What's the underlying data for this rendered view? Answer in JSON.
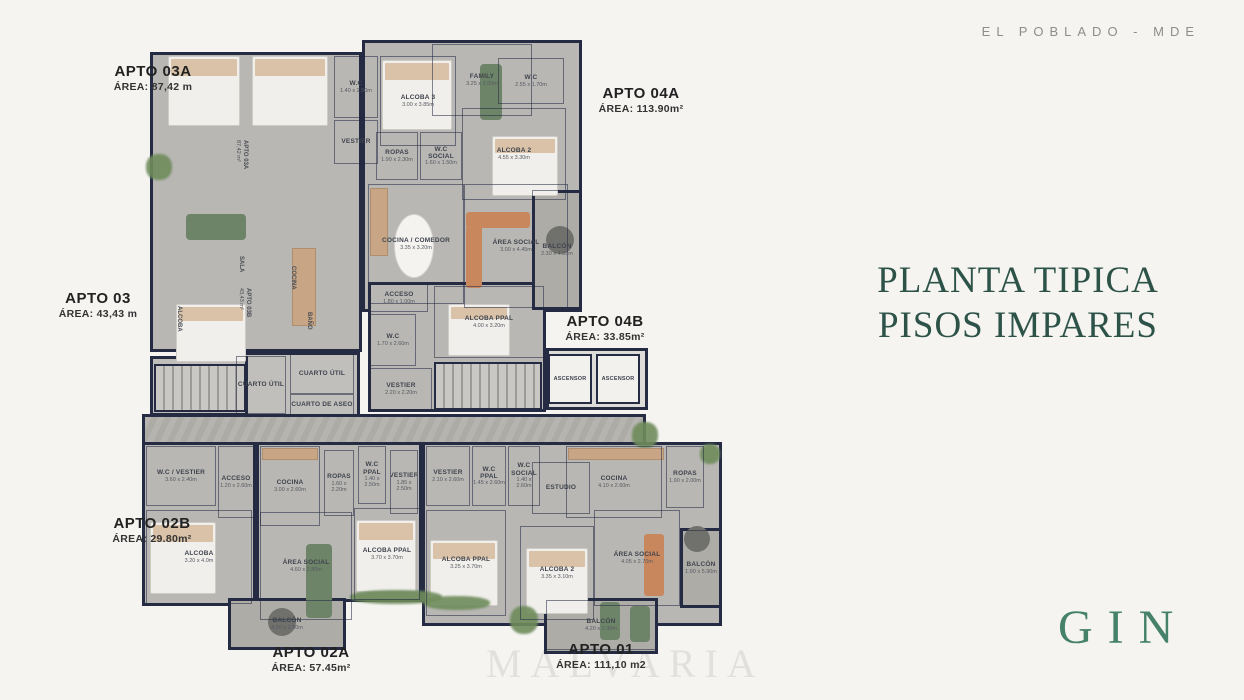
{
  "header": {
    "location_tag": "EL POBLADO - MDE"
  },
  "title": {
    "line1": "PLANTA TIPICA",
    "line2": "PISOS IMPARES"
  },
  "brand": {
    "name": "GIN"
  },
  "watermark": "MALVARIA",
  "colors": {
    "page_bg": "#f5f4f1",
    "title_green": "#2d5349",
    "brand_green": "#45816b",
    "wall_navy": "#242b43",
    "floor_gray": "#b8b7b3",
    "wood_tan": "#c8a685",
    "sofa_green": "#6d8468",
    "sofa_orange": "#c9875e"
  },
  "apartments": [
    {
      "name": "APTO 03A",
      "area": "ÁREA: 87,42 m",
      "cx": 153,
      "y": 64
    },
    {
      "name": "APTO 04A",
      "area": "ÁREA: 113.90m²",
      "cx": 641,
      "y": 86
    },
    {
      "name": "APTO 03",
      "area": "ÁREA: 43,43 m",
      "cx": 98,
      "y": 291
    },
    {
      "name": "APTO 04B",
      "area": "ÁREA: 33.85m²",
      "cx": 605,
      "y": 314
    },
    {
      "name": "APTO 02B",
      "area": "ÁREA: 29.80m²",
      "cx": 152,
      "y": 516
    },
    {
      "name": "APTO 02A",
      "area": "ÁREA: 57.45m²",
      "cx": 311,
      "y": 645
    },
    {
      "name": "APTO 01",
      "area": "ÁREA: 111,10 m2",
      "cx": 601,
      "y": 642
    }
  ],
  "floor_plan": {
    "blocks": [
      {
        "kind": "floor",
        "g": [
          150,
          52,
          212,
          300
        ]
      },
      {
        "kind": "floor",
        "g": [
          362,
          40,
          220,
          272
        ]
      },
      {
        "kind": "floor",
        "g": [
          368,
          282,
          178,
          130
        ]
      },
      {
        "kind": "lobby",
        "g": [
          546,
          348,
          102,
          62
        ]
      },
      {
        "kind": "floor2",
        "g": [
          232,
          352,
          128,
          66
        ]
      },
      {
        "kind": "floor2",
        "g": [
          150,
          356,
          98,
          60
        ]
      },
      {
        "kind": "corridor",
        "g": [
          142,
          414,
          504,
          42
        ]
      },
      {
        "kind": "floor",
        "g": [
          142,
          442,
          114,
          164
        ]
      },
      {
        "kind": "floor",
        "g": [
          256,
          442,
          166,
          160
        ]
      },
      {
        "kind": "floor",
        "g": [
          422,
          442,
          300,
          184
        ]
      },
      {
        "kind": "balcony",
        "g": [
          532,
          190,
          50,
          120
        ]
      },
      {
        "kind": "balcony",
        "g": [
          680,
          528,
          42,
          80
        ]
      },
      {
        "kind": "balcony",
        "g": [
          228,
          598,
          118,
          52
        ]
      },
      {
        "kind": "balcony",
        "g": [
          544,
          598,
          114,
          56
        ]
      }
    ],
    "rooms": [
      {
        "label": "W.C",
        "dims": "1.40 x 2.50m",
        "g": [
          334,
          56,
          44,
          62
        ]
      },
      {
        "label": "VESTIER",
        "dims": "",
        "g": [
          334,
          120,
          44,
          44
        ]
      },
      {
        "label": "ALCOBA 3",
        "dims": "3.00 x 3.85m",
        "g": [
          380,
          56,
          76,
          90
        ]
      },
      {
        "label": "FAMILY",
        "dims": "3.25 x 3.00m",
        "g": [
          432,
          44,
          100,
          72
        ]
      },
      {
        "label": "W.C",
        "dims": "2.55 x 1.70m",
        "g": [
          498,
          58,
          66,
          46
        ]
      },
      {
        "label": "ALCOBA 2",
        "dims": "4.55 x 3.30m",
        "g": [
          462,
          108,
          104,
          92
        ]
      },
      {
        "label": "ROPAS",
        "dims": "1.90 x 2.30m",
        "g": [
          376,
          132,
          42,
          48
        ]
      },
      {
        "label": "W.C SOCIAL",
        "dims": "1.60 x 1.50m",
        "g": [
          420,
          132,
          42,
          48
        ]
      },
      {
        "label": "COCINA / COMEDOR",
        "dims": "3.35 x 3.20m",
        "g": [
          368,
          184,
          96,
          120
        ]
      },
      {
        "label": "ÁREA SOCIAL",
        "dims": "3.00 x 4.45m",
        "g": [
          464,
          184,
          104,
          124
        ]
      },
      {
        "label": "BALCÓN",
        "dims": "2.30 x 4.85m",
        "g": [
          532,
          190,
          50,
          120
        ]
      },
      {
        "label": "ACCESO",
        "dims": "1.80 x 1.00m",
        "g": [
          370,
          284,
          58,
          28
        ]
      },
      {
        "label": "W.C",
        "dims": "1.70 x 2.60m",
        "g": [
          370,
          314,
          46,
          52
        ]
      },
      {
        "label": "VESTIER",
        "dims": "2.20 x 2.20m",
        "g": [
          370,
          368,
          62,
          42
        ]
      },
      {
        "label": "ALCOBA PPAL",
        "dims": "4.00 x 3.20m",
        "g": [
          434,
          286,
          110,
          72
        ]
      },
      {
        "label": "ASCENSOR",
        "dims": "",
        "kind": "lift",
        "g": [
          548,
          354,
          44,
          50
        ]
      },
      {
        "label": "ASCENSOR",
        "dims": "",
        "kind": "lift",
        "g": [
          596,
          354,
          44,
          50
        ]
      },
      {
        "label": "CUARTO ÚTIL",
        "dims": "",
        "g": [
          236,
          356,
          50,
          58
        ]
      },
      {
        "label": "CUARTO ÚTIL",
        "dims": "",
        "g": [
          290,
          354,
          64,
          40
        ]
      },
      {
        "label": "CUARTO DE ASEO",
        "dims": "",
        "g": [
          290,
          394,
          64,
          22
        ]
      },
      {
        "label": "W.C / VESTIER",
        "dims": "3.60 x 2.40m",
        "g": [
          146,
          446,
          70,
          60
        ]
      },
      {
        "label": "ACCESO",
        "dims": "1.20 x 2.60m",
        "g": [
          218,
          446,
          36,
          72
        ]
      },
      {
        "label": "ALCOBA",
        "dims": "3.20 x 4.0m",
        "g": [
          146,
          510,
          106,
          94
        ]
      },
      {
        "label": "COCINA",
        "dims": "3.00 x 2.60m",
        "g": [
          260,
          446,
          60,
          80
        ]
      },
      {
        "label": "ROPAS",
        "dims": "1.60 x 2.20m",
        "g": [
          324,
          450,
          30,
          66
        ]
      },
      {
        "label": "W.C PPAL",
        "dims": "1.40 x 2.50m",
        "g": [
          358,
          446,
          28,
          58
        ]
      },
      {
        "label": "VESTIER",
        "dims": "1.85 x 2.50m",
        "g": [
          390,
          450,
          28,
          64
        ]
      },
      {
        "label": "ÁREA SOCIAL",
        "dims": "4.60 x 2.80m",
        "g": [
          260,
          512,
          92,
          108
        ]
      },
      {
        "label": "ALCOBA PPAL",
        "dims": "3.70 x 3.70m",
        "g": [
          354,
          508,
          66,
          92
        ]
      },
      {
        "label": "BALCÓN",
        "dims": "4.50 x 2.00m",
        "g": [
          230,
          600,
          114,
          48
        ]
      },
      {
        "label": "VESTIER",
        "dims": "2.10 x 2.60m",
        "g": [
          426,
          446,
          44,
          60
        ]
      },
      {
        "label": "W.C PPAL",
        "dims": "1.45 x 2.60m",
        "g": [
          472,
          446,
          34,
          60
        ]
      },
      {
        "label": "W.C SOCIAL",
        "dims": "1.40 x 2.60m",
        "g": [
          508,
          446,
          32,
          60
        ]
      },
      {
        "label": "ESTUDIO",
        "dims": "",
        "g": [
          532,
          462,
          58,
          52
        ]
      },
      {
        "label": "COCINA",
        "dims": "4.10 x 2.60m",
        "g": [
          566,
          446,
          96,
          72
        ]
      },
      {
        "label": "ROPAS",
        "dims": "1.90 x 2.00m",
        "g": [
          666,
          446,
          38,
          62
        ]
      },
      {
        "label": "ALCOBA PPAL",
        "dims": "3.25 x 3.70m",
        "g": [
          426,
          510,
          80,
          106
        ]
      },
      {
        "label": "ALCOBA 2",
        "dims": "3.35 x 3.10m",
        "g": [
          520,
          526,
          74,
          94
        ]
      },
      {
        "label": "ÁREA SOCIAL",
        "dims": "4.05 x 2.70m",
        "g": [
          594,
          510,
          86,
          96
        ]
      },
      {
        "label": "BALCÓN",
        "dims": "1.90 x 5.90m",
        "g": [
          682,
          530,
          38,
          76
        ]
      },
      {
        "label": "BALCÓN",
        "dims": "4.20 x 2.30m",
        "g": [
          546,
          600,
          110,
          50
        ]
      }
    ],
    "rotated_labels": [
      {
        "t": "APTO 03A",
        "s": "87,42 m²",
        "x": 248,
        "y": 140
      },
      {
        "t": "SALA",
        "s": "",
        "x": 244,
        "y": 256
      },
      {
        "t": "COCINA",
        "s": "",
        "x": 296,
        "y": 266
      },
      {
        "t": "APTO 03B",
        "s": "43,43 m²",
        "x": 251,
        "y": 288
      },
      {
        "t": "ALCOBA",
        "s": "",
        "x": 182,
        "y": 306
      },
      {
        "t": "BAÑO",
        "s": "",
        "x": 312,
        "y": 312
      }
    ],
    "furniture": [
      {
        "type": "bed",
        "g": [
          168,
          56,
          72,
          70
        ]
      },
      {
        "type": "bed",
        "g": [
          252,
          56,
          76,
          70
        ]
      },
      {
        "type": "bed",
        "g": [
          382,
          60,
          70,
          70
        ]
      },
      {
        "type": "bed",
        "g": [
          492,
          136,
          66,
          60
        ]
      },
      {
        "type": "bed",
        "g": [
          176,
          304,
          70,
          58
        ]
      },
      {
        "type": "bed",
        "g": [
          448,
          304,
          62,
          52
        ]
      },
      {
        "type": "bed",
        "g": [
          150,
          522,
          66,
          72
        ]
      },
      {
        "type": "bed",
        "g": [
          356,
          520,
          60,
          72
        ]
      },
      {
        "type": "bed",
        "g": [
          430,
          540,
          68,
          66
        ]
      },
      {
        "type": "bed",
        "g": [
          526,
          548,
          62,
          66
        ]
      },
      {
        "type": "sofa-g",
        "g": [
          186,
          214,
          60,
          26
        ]
      },
      {
        "type": "sofa-g",
        "g": [
          480,
          64,
          22,
          56
        ]
      },
      {
        "type": "sofa-o",
        "g": [
          466,
          212,
          64,
          16
        ]
      },
      {
        "type": "sofa-o",
        "g": [
          466,
          226,
          16,
          62
        ]
      },
      {
        "type": "sofa-g",
        "g": [
          306,
          544,
          26,
          74
        ]
      },
      {
        "type": "sofa-o",
        "g": [
          644,
          534,
          20,
          62
        ]
      },
      {
        "type": "sofa-g",
        "g": [
          600,
          602,
          20,
          38
        ]
      },
      {
        "type": "sofa-g",
        "g": [
          630,
          606,
          20,
          36
        ]
      },
      {
        "type": "table-w",
        "g": [
          394,
          214,
          40,
          64
        ]
      },
      {
        "type": "table-d",
        "g": [
          546,
          226,
          28,
          28
        ]
      },
      {
        "type": "table-d",
        "g": [
          268,
          608,
          28,
          28
        ]
      },
      {
        "type": "table-d",
        "g": [
          684,
          526,
          26,
          26
        ]
      },
      {
        "type": "stairs",
        "g": [
          434,
          362,
          108,
          48
        ]
      },
      {
        "type": "stairs",
        "g": [
          154,
          364,
          92,
          48
        ]
      },
      {
        "type": "plant",
        "g": [
          146,
          154,
          26,
          26
        ]
      },
      {
        "type": "plant",
        "g": [
          632,
          422,
          26,
          26
        ]
      },
      {
        "type": "plant",
        "g": [
          510,
          606,
          28,
          28
        ]
      },
      {
        "type": "plant",
        "g": [
          350,
          590,
          92,
          14
        ]
      },
      {
        "type": "plant",
        "g": [
          424,
          596,
          66,
          14
        ]
      },
      {
        "type": "plant",
        "g": [
          700,
          444,
          20,
          20
        ]
      },
      {
        "type": "wood",
        "g": [
          370,
          188,
          18,
          68
        ]
      },
      {
        "type": "wood",
        "g": [
          262,
          448,
          56,
          12
        ]
      },
      {
        "type": "wood",
        "g": [
          568,
          448,
          96,
          12
        ]
      },
      {
        "type": "wood",
        "g": [
          292,
          248,
          24,
          78
        ]
      }
    ]
  }
}
